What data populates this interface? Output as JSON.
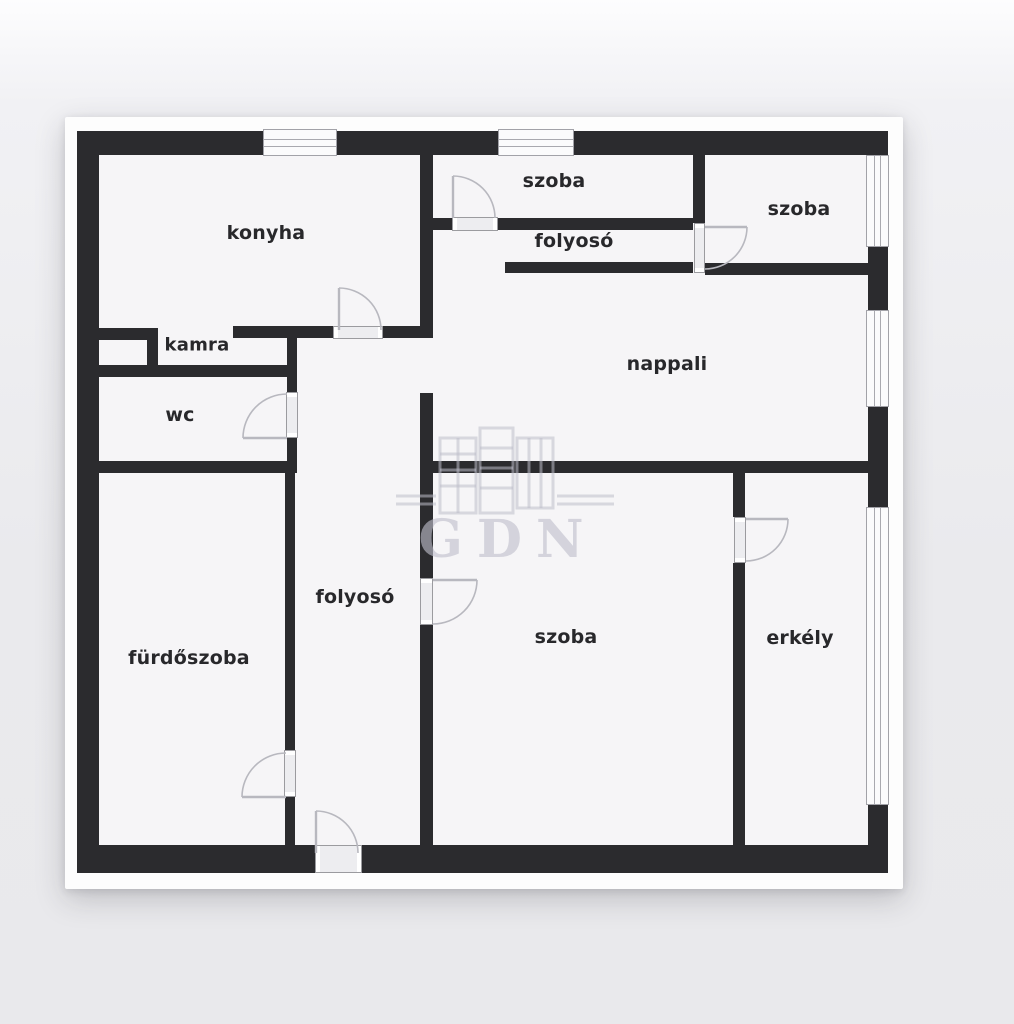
{
  "watermark": {
    "text": "GDN"
  },
  "rooms": [
    {
      "id": "konyha",
      "label": "konyha"
    },
    {
      "id": "kamra",
      "label": "kamra"
    },
    {
      "id": "wc",
      "label": "wc"
    },
    {
      "id": "szoba-top",
      "label": "szoba"
    },
    {
      "id": "folyoso-top",
      "label": "folyosó"
    },
    {
      "id": "szoba-top-right",
      "label": "szoba"
    },
    {
      "id": "nappali",
      "label": "nappali"
    },
    {
      "id": "furdoszoba",
      "label": "fürdőszoba"
    },
    {
      "id": "folyoso-bottom",
      "label": "folyosó"
    },
    {
      "id": "szoba-bottom",
      "label": "szoba"
    },
    {
      "id": "erkely",
      "label": "erkély"
    }
  ],
  "colors": {
    "wall": "#2b2b2e",
    "floor": "#f6f5f7",
    "card": "#fdfdfd",
    "page_background": "#eaeaed",
    "watermark": "#c6c6d2"
  }
}
